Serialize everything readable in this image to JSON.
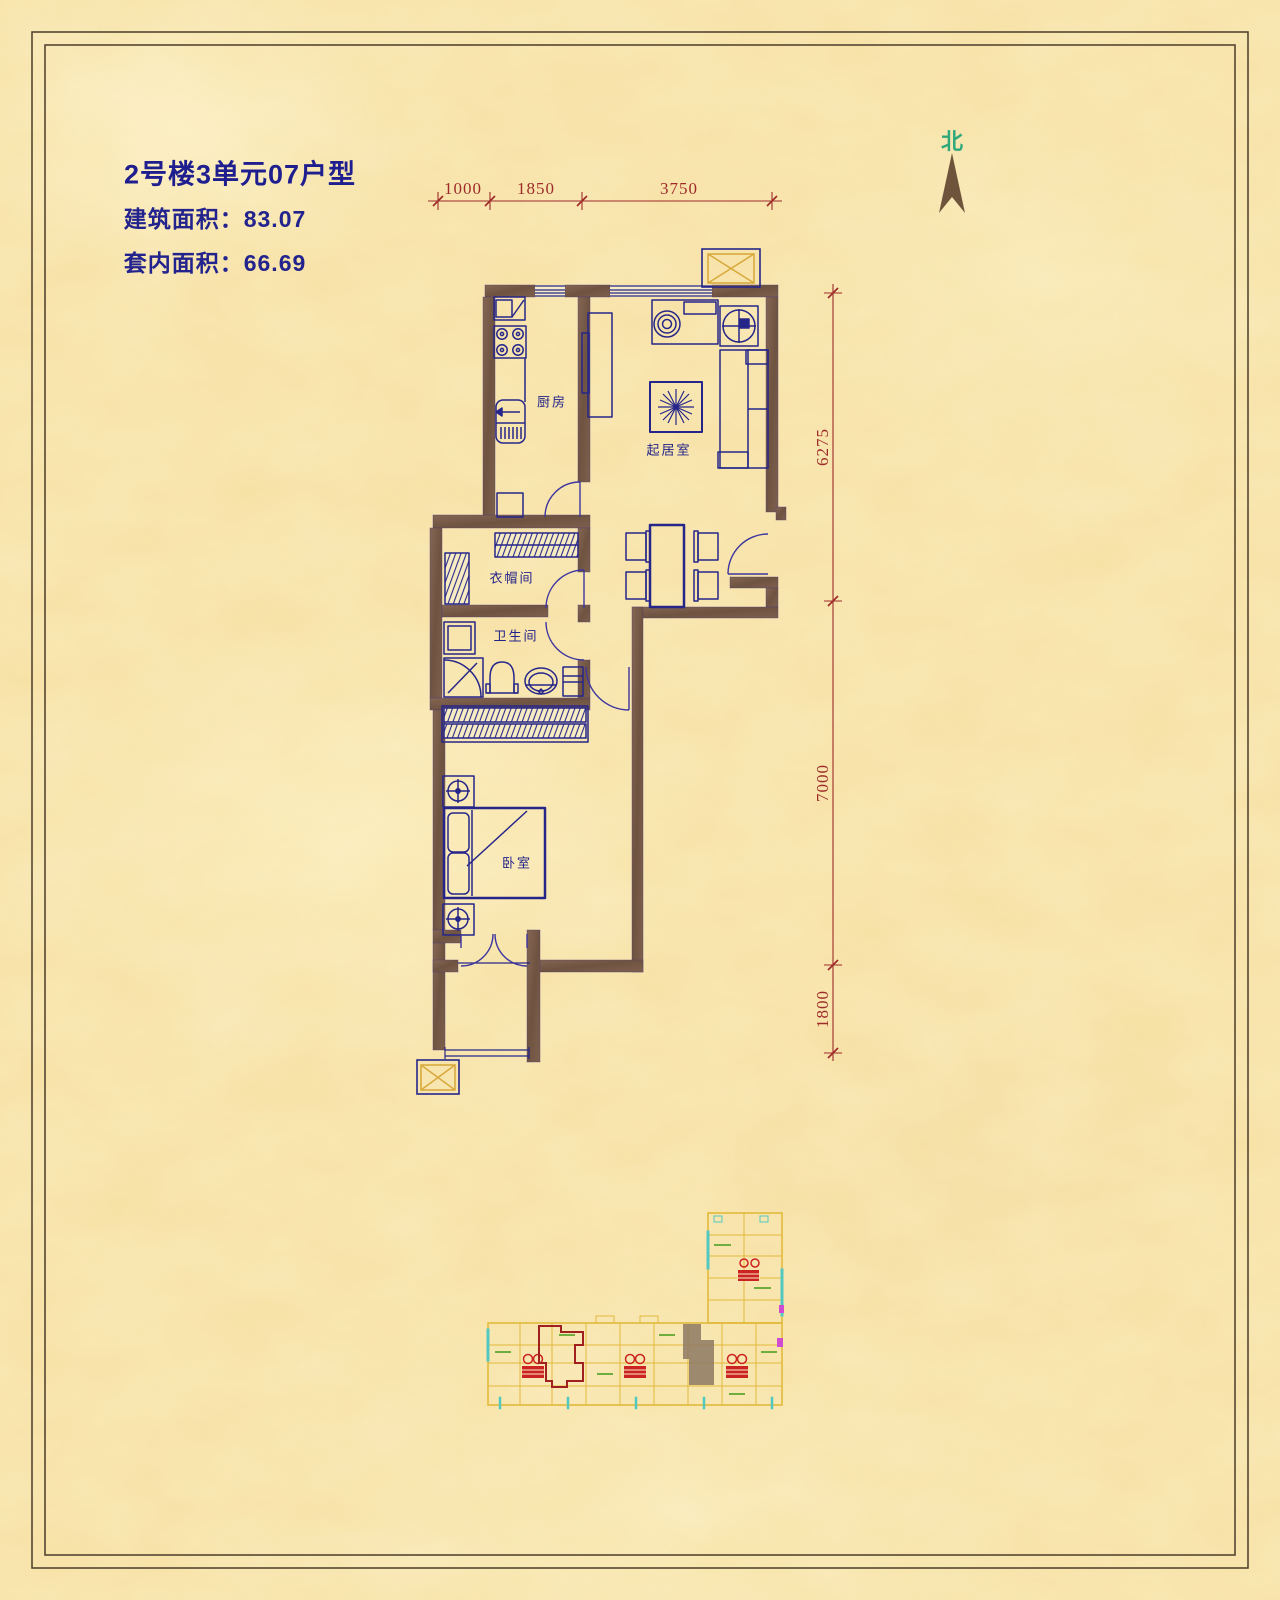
{
  "header": {
    "title": "2号楼3单元07户型",
    "building_area": "建筑面积：83.07",
    "inner_area": "套内面积：66.69"
  },
  "compass": {
    "label": "北"
  },
  "dimensions": {
    "top": [
      "1000",
      "1850",
      "3750"
    ],
    "right": [
      "6275",
      "7000",
      "1800"
    ]
  },
  "rooms": {
    "kitchen": "厨房",
    "living": "起居室",
    "cloakroom": "衣帽间",
    "bathroom": "卫生间",
    "bedroom": "卧室"
  },
  "colors": {
    "background": "#f7e2a6",
    "wall": "#7d5f4c",
    "fixture_line": "#26268a",
    "door_line": "#3d35a0",
    "dimension": "#9e2a2a",
    "title_text": "#1e1e8f",
    "compass_label": "#2fa87c",
    "flue_x": "#d9aa3e",
    "site_outline": "#e2b93b",
    "site_accent": "#53c8c0",
    "site_green": "#6fae3e",
    "site_stair": "#cc2222",
    "site_highlight": "#a02020",
    "site_shadow": "#8d7963"
  }
}
